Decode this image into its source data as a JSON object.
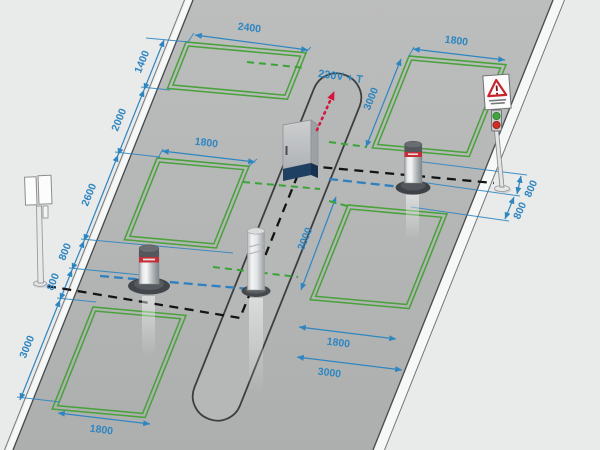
{
  "diagram": {
    "power_label": "230V + T",
    "dimensions": [
      {
        "v": "2400",
        "x": 249,
        "y": 31,
        "r": 7
      },
      {
        "v": "1400",
        "x": 145,
        "y": 63,
        "r": -68
      },
      {
        "v": "2000",
        "x": 122,
        "y": 121,
        "r": -68
      },
      {
        "v": "2600",
        "x": 92,
        "y": 196,
        "r": -68
      },
      {
        "v": "800",
        "x": 68,
        "y": 253,
        "r": -68
      },
      {
        "v": "800",
        "x": 56,
        "y": 283,
        "r": -68
      },
      {
        "v": "3000",
        "x": 30,
        "y": 348,
        "r": -68
      },
      {
        "v": "1800",
        "x": 206,
        "y": 146,
        "r": 7
      },
      {
        "v": "1800",
        "x": 101,
        "y": 433,
        "r": 7
      },
      {
        "v": "1800",
        "x": 456,
        "y": 44,
        "r": 7
      },
      {
        "v": "3000",
        "x": 374,
        "y": 100,
        "r": -68
      },
      {
        "v": "3000",
        "x": 308,
        "y": 240,
        "r": -68
      },
      {
        "v": "1800",
        "x": 338,
        "y": 346,
        "r": 7
      },
      {
        "v": "3000",
        "x": 329,
        "y": 376,
        "r": 7
      },
      {
        "v": "800",
        "x": 534,
        "y": 190,
        "r": -66
      },
      {
        "v": "800",
        "x": 523,
        "y": 212,
        "r": -66
      }
    ],
    "colors": {
      "background": "#e9eaea",
      "road": "#b4b5b5",
      "loop_green": "#4aa23c",
      "dimension_blue": "#2e86c1",
      "cable_black": "#141414",
      "cable_blue": "#2f7fc1",
      "cable_green": "#3aa437",
      "power_red": "#d5173f",
      "bollard_band_red": "#c42f38",
      "control_unit_base_blue": "#1f4063",
      "signal_green": "#3fa53c",
      "signal_red": "#d02f24"
    },
    "components": {
      "road": "roadway",
      "island": "traffic-island",
      "loops": [
        "induction-loop-top-left",
        "induction-loop-mid-left",
        "induction-loop-bottom-left",
        "induction-loop-top-right",
        "induction-loop-bottom-right"
      ],
      "bollards": [
        "automatic-bollard-left",
        "fixed-bollard-center",
        "automatic-bollard-right"
      ],
      "control_unit": "control-unit-cabinet",
      "warning_sign": "warning-sign-with-traffic-light",
      "entry_post": "intercom-post"
    }
  }
}
